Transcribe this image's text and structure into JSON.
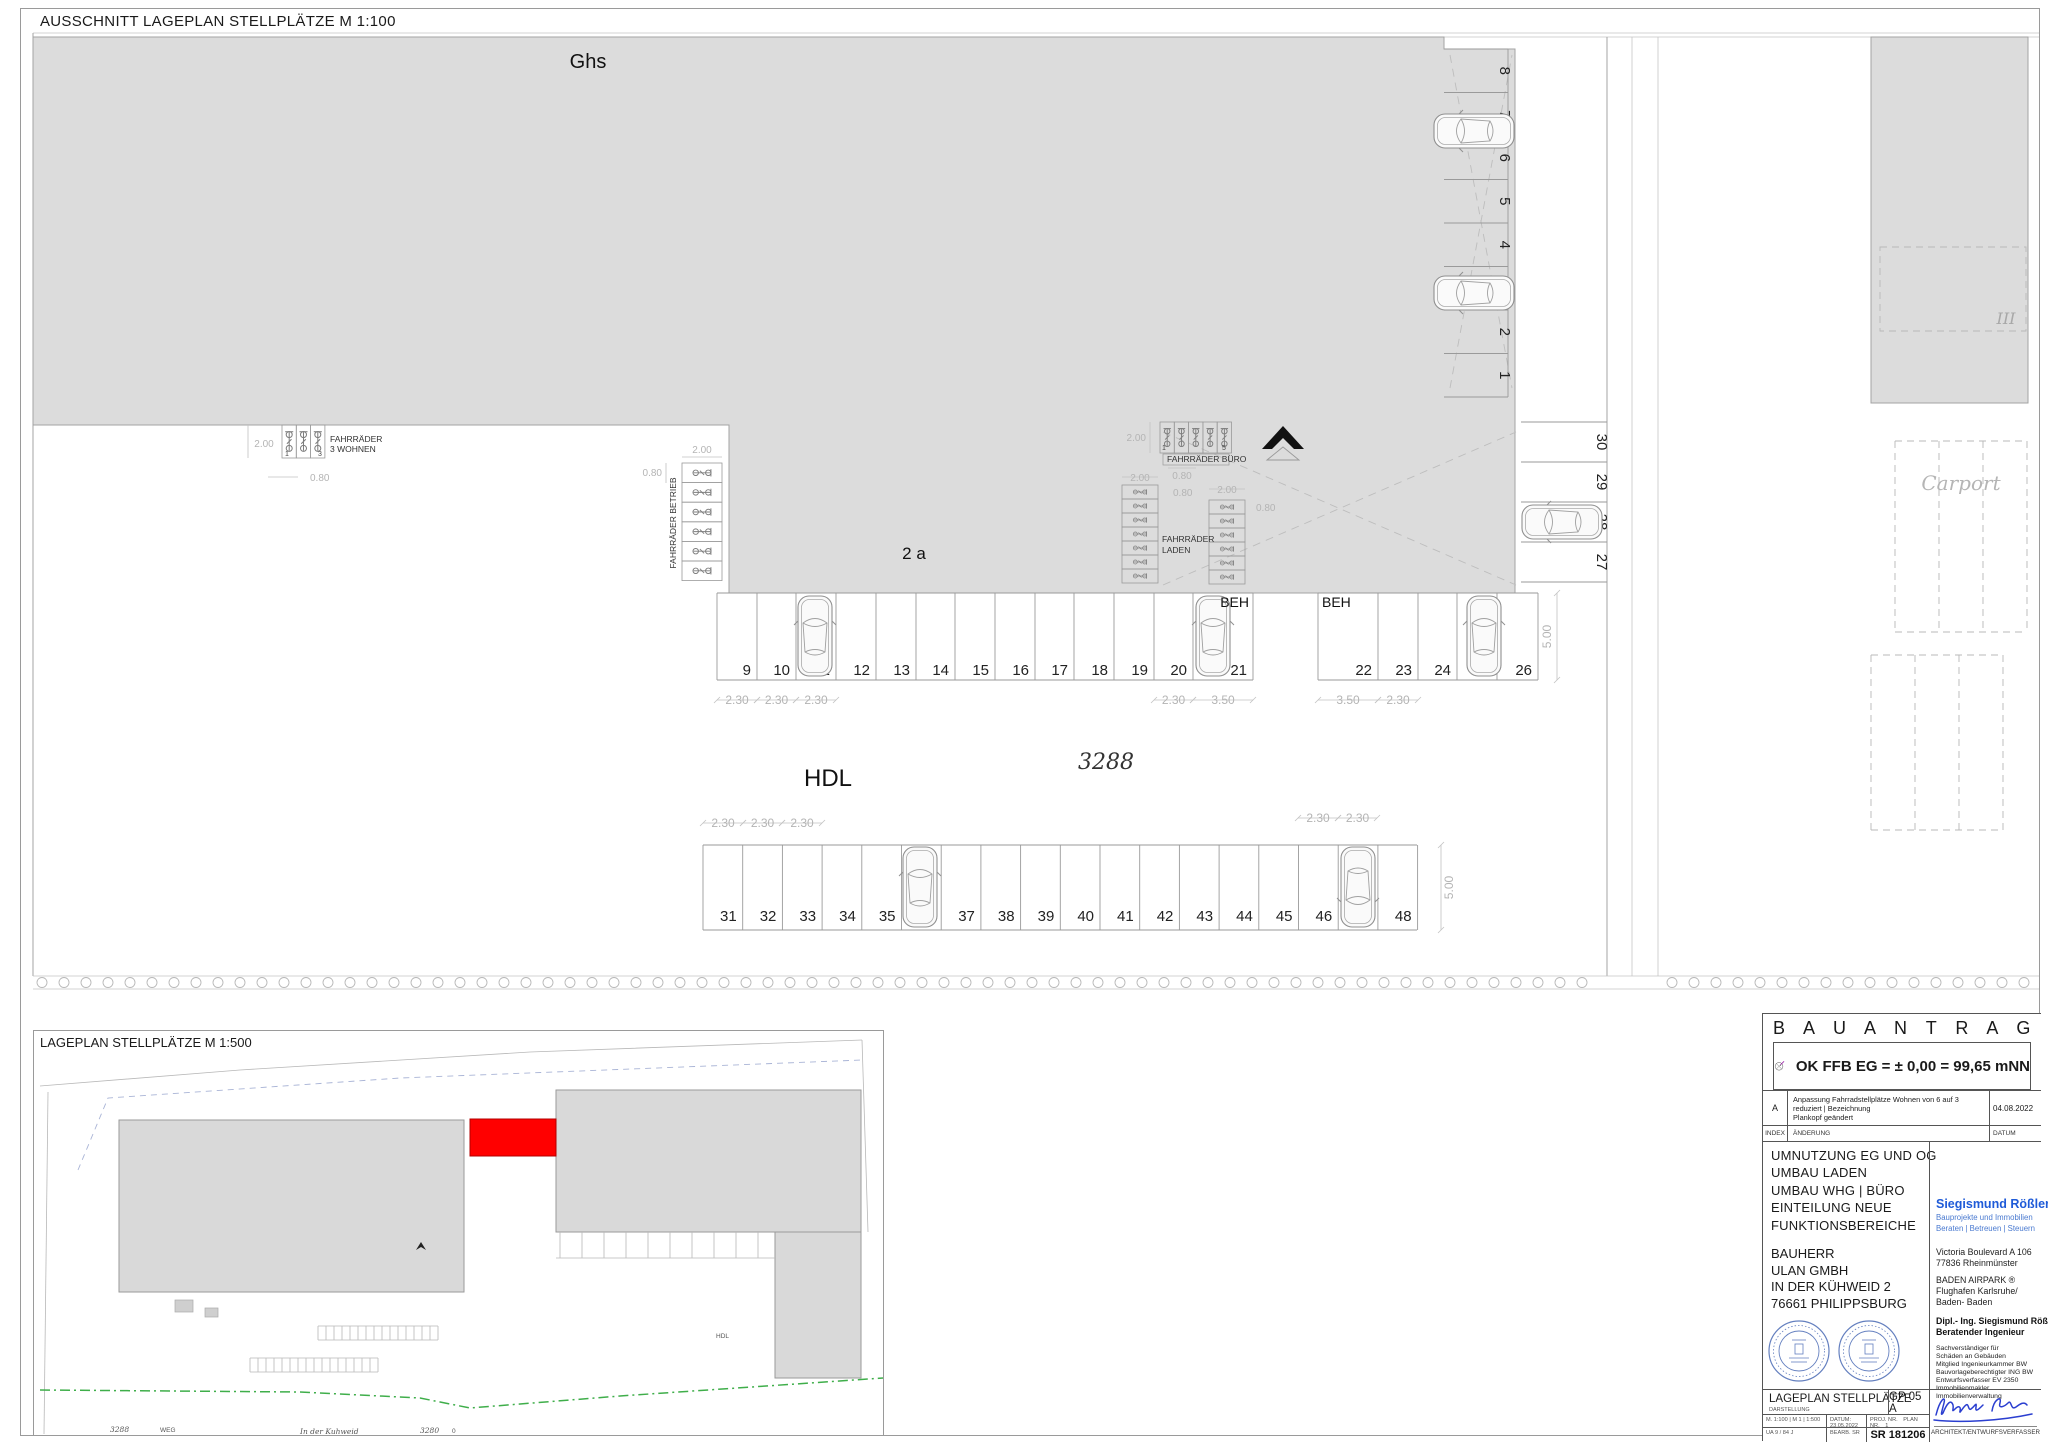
{
  "page": {
    "main_title": "AUSSCHNITT LAGEPLAN STELLPLÄTZE M 1:100",
    "mini_title": "LAGEPLAN STELLPLÄTZE M 1:500"
  },
  "plan": {
    "building_main_label": "Ghs",
    "building_annex_label": "2 a",
    "building_east_label": "III",
    "street_label": "HDL",
    "parcel_number": "3288",
    "carport_label": "Carport",
    "accessible_label_1": "BEH",
    "accessible_label_2": "BEH",
    "stalls_middle": [
      "9",
      "10",
      "11",
      "12",
      "13",
      "14",
      "15",
      "16",
      "17",
      "18",
      "19",
      "20",
      "21",
      "22",
      "23",
      "24",
      "25",
      "26"
    ],
    "stalls_bottom": [
      "31",
      "32",
      "33",
      "34",
      "35",
      "36",
      "37",
      "38",
      "39",
      "40",
      "41",
      "42",
      "43",
      "44",
      "45",
      "46",
      "47",
      "48"
    ],
    "stalls_north": [
      "1",
      "2",
      "3",
      "4",
      "5",
      "6",
      "7",
      "8"
    ],
    "stalls_east": [
      "27",
      "28",
      "29",
      "30"
    ],
    "dim_230": "2.30",
    "dim_350": "3.50",
    "dim_500": "5.00",
    "dim_200": "2.00",
    "dim_080": "0.80",
    "bike_wohnen_line1": "FAHRRÄDER",
    "bike_wohnen_line2": "3 WOHNEN",
    "bike_wohnen_num1": "1",
    "bike_wohnen_num2": "3",
    "bike_buero_label": "FAHRRÄDER BÜRO",
    "bike_buero_num1": "1",
    "bike_buero_num2": "5",
    "bike_laden_line1": "FAHRRÄDER",
    "bike_laden_line2": "LADEN",
    "bike_betrieb_label": "FAHRRÄDER BETRIEB"
  },
  "miniplan": {
    "street_label": "In der Kuhweid",
    "weg_label": "WEG",
    "parcel_label_1": "3288",
    "parcel_label_2": "3280",
    "zero_label": "0",
    "hdl_label": "HDL"
  },
  "titleblock": {
    "header": "B A U A N T R A G",
    "level_note": "OK FFB EG = ± 0,00 = 99,65 mNN",
    "revision": {
      "index": "A",
      "text_line1": "Anpassung Fahrradstellplätze Wohnen von 6 auf 3 reduziert | Bezeichnung",
      "text_line2": "Plankopf geändert",
      "date": "04.08.2022",
      "col_index": "INDEX",
      "col_change": "ÄNDERUNG",
      "col_date": "DATUM"
    },
    "project": [
      "UMNUTZUNG EG UND OG",
      "UMBAU LADEN",
      "UMBAU WHG | BÜRO",
      "EINTEILUNG NEUE",
      "FUNKTIONSBEREICHE"
    ],
    "client_label": "BAUHERR",
    "client": [
      "ULAN GMBH",
      "IN DER KÜHWEID 2",
      "76661 PHILIPPSBURG"
    ],
    "firm": {
      "name": "Siegismund Rößler",
      "reg": "®",
      "tagline1": "Bauprojekte und Immobilien",
      "tagline2": "Beraten | Betreuen | Steuern",
      "addr1a": "Victoria Boulevard A 106",
      "addr1b": "77836 Rheinmünster",
      "addr2a": "BADEN AIRPARK ®",
      "addr2b": "Flughafen Karlsruhe/",
      "addr2c": "Baden- Baden",
      "eng1": "Dipl.- Ing. Siegismund Rößler",
      "eng2": "Beratender Ingenieur",
      "quals": [
        "Sachverständiger für",
        "Schäden an Gebäuden",
        "Mitglied Ingenieurkammer BW",
        "Bauvorlageberechtigter ING BW",
        "Entwurfsverfasser EV 2350",
        "Immobilienmakler",
        "Immobilienverwaltung"
      ]
    },
    "footer": {
      "doc_title": "LAGEPLAN STELLPLÄTZE",
      "darstellung": "DARSTELLUNG",
      "scale_text": "M. 1:100 | M 1 | 1:500",
      "datum_text": "DATUM: 23.05.2022",
      "proj_label": "PROJ. NR.",
      "plan_label": "PLAN NR.",
      "plan_index": "1",
      "sheet_text": "UA 9 / 84 J",
      "bearb_text": "BEARB. SR",
      "plan_code": "GP 05 A",
      "project_no": "SR 181206",
      "architect_label": "ARCHITEKT/ENTWURFSVERFASSER"
    }
  },
  "colors": {
    "building_gray": "#dcdcdc",
    "highlight_red": "#ff0000",
    "brand_blue": "#1f5bd8",
    "stamp_blue": "#4a6ab5",
    "signature_blue": "#2b3fd0",
    "boundary_green": "#3fae4a"
  }
}
